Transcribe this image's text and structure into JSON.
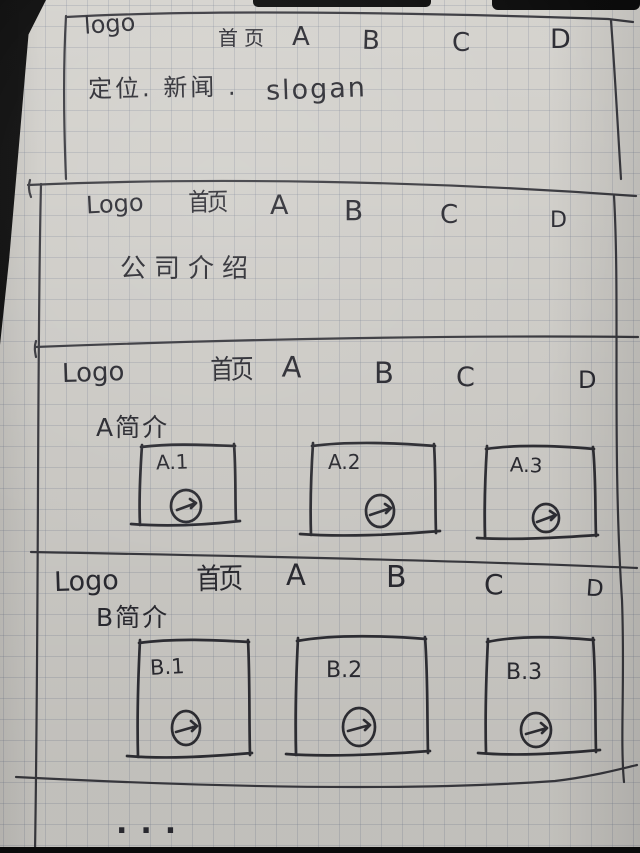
{
  "colors": {
    "ink": "#3c3c42",
    "paper": "#d9d7d2",
    "grid_line": "#7d8798",
    "backdrop": "#0c0c0c"
  },
  "sections": [
    {
      "name": "hero",
      "nav": {
        "logo": "logo",
        "items": [
          "首页",
          "A",
          "B",
          "C",
          "D"
        ]
      },
      "tagline": "定位. 新闻 .",
      "slogan": "slogan"
    },
    {
      "name": "company-intro",
      "nav": {
        "logo": "Logo",
        "items": [
          "首页",
          "A",
          "B",
          "C",
          "D"
        ]
      },
      "content": "公司介绍"
    },
    {
      "name": "section-a",
      "nav": {
        "logo": "Logo",
        "items": [
          "首页",
          "A",
          "B",
          "C",
          "D"
        ]
      },
      "heading": "A简介",
      "cards": [
        {
          "label": "A.1",
          "icon": "arrow-right-circle"
        },
        {
          "label": "A.2",
          "icon": "arrow-right-circle"
        },
        {
          "label": "A.3",
          "icon": "arrow-right-circle"
        }
      ]
    },
    {
      "name": "section-b",
      "nav": {
        "logo": "Logo",
        "items": [
          "首页",
          "A",
          "B",
          "C",
          "D"
        ]
      },
      "heading": "B简介",
      "cards": [
        {
          "label": "B.1",
          "icon": "arrow-right-circle"
        },
        {
          "label": "B.2",
          "icon": "arrow-right-circle"
        },
        {
          "label": "B.3",
          "icon": "arrow-right-circle"
        }
      ]
    }
  ],
  "footer": {
    "ellipsis": "..."
  }
}
